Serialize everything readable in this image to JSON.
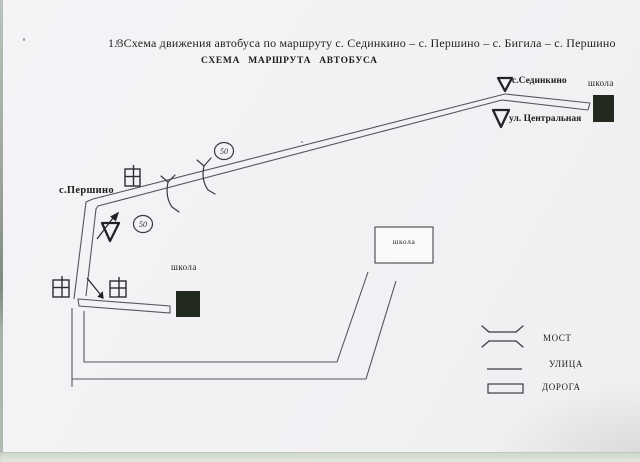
{
  "document": {
    "title": "1.3Схема движения автобуса по маршруту с. Сединкино – с. Першино – с. Бигила – с. Першино",
    "subtitle": "СХЕМА МАРШРУТА АВТОБУСА"
  },
  "diagram": {
    "labels": {
      "sedinkino": "с.Сединкино",
      "ul_centralnaya": "ул. Центральная",
      "pershino": "с.Першино",
      "school_top_right": "школа",
      "school_left": "школа",
      "school_center": "школа"
    },
    "speed_signs": [
      {
        "value": "50"
      },
      {
        "value": "50"
      }
    ]
  },
  "legend": {
    "items": [
      {
        "id": "bridge",
        "label": "МОСТ"
      },
      {
        "id": "street",
        "label": "УЛИЦА"
      },
      {
        "id": "road",
        "label": "ДОРОГА"
      }
    ]
  },
  "colors": {
    "ink": "#4f4f56",
    "symbol_ink": "#232327",
    "paper": "#f2f1f4",
    "school_fill": "#222a20"
  }
}
